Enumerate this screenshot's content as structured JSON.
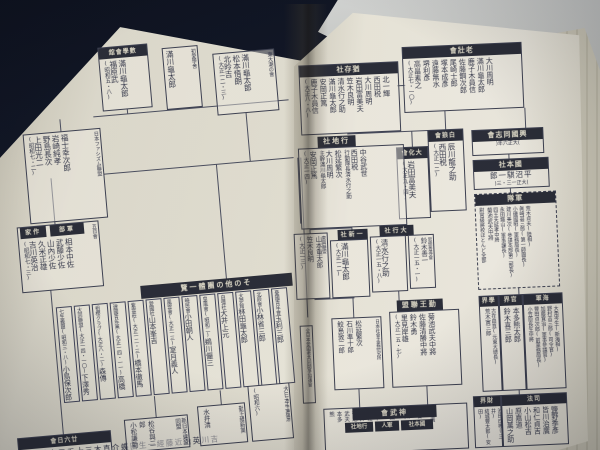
{
  "photo": {
    "background": "#11151f",
    "left_page": "#e4e0d0",
    "right_page": "#f0ecdd",
    "ink": "#343748",
    "header_bg": "#2b2d36",
    "header_fg": "#e4dfcb"
  },
  "left_page": {
    "box_a": {
      "header": "數學會舘",
      "members": [
        "滿川龜太郎",
        "福原武",
        "(昭和五・八)"
      ]
    },
    "box_b": {
      "side_label": "初愛學舍",
      "members": [
        "滿川龜太郎"
      ]
    },
    "box_c": {
      "side_label": "東大潮の會",
      "members": [
        "滿川龜太郎",
        "松本悟朗",
        "北昤吉",
        "(大正一二・三)"
      ]
    },
    "fascism_league": {
      "side_label": "日本ファシズム聯盟",
      "members": [
        "福士幸次郎",
        "岩崎純孝",
        "野島長次",
        "上田光二",
        "(昭和七・二)"
      ]
    },
    "itsukakai": {
      "side_label": "五日會",
      "header_sakka": "作家",
      "header_gunbu": "軍部",
      "members": [
        "相本中佐",
        "武藤少佐",
        "山內少佐",
        "久米正雄",
        "吉川英治",
        "(昭和七・三)"
      ]
    },
    "band": {
      "header": "その他の團體一覽",
      "entries": [
        {
          "label": "七生義團(昭和三・八)",
          "name": "小島保次郎"
        },
        {
          "label": "大同聯盟(大正一四・一〇)",
          "name": "下澤秀夫"
        },
        {
          "label": "祖櫻クラブ(大正八・二)",
          "name": "森傳"
        },
        {
          "label": "建國青年黨(大正一四・一一)",
          "name": "高橋佐三郎"
        },
        {
          "label": "紫雲莊(大正一二・三)",
          "name": "橋本徹馬"
        },
        {
          "label": "愛國社",
          "name": "山本峯吉"
        },
        {
          "label": "風雲會(大正一三)",
          "name": "室月義人"
        },
        {
          "label": "曉民會",
          "name": "小田朝人"
        },
        {
          "label": "皇風會(昭和二)",
          "name": "鵜川儼三"
        },
        {
          "label": "自彊社",
          "name": "大井上元"
        },
        {
          "label": "大夢館",
          "name": "林田龜太郎"
        },
        {
          "label": "北辰會",
          "name": "小林省三郎"
        },
        {
          "label": "憂國青年會",
          "name": "玉利三郎"
        }
      ]
    },
    "writers_box": {
      "header": "廿六日會",
      "members": [
        "吉川英治",
        "近藤經一",
        "生田蝶介",
        "直木三十五",
        "三上於菟吉"
      ]
    },
    "bottom_box_1": {
      "side_label": "新日本建設同盟",
      "members": [
        "松谷與二郎",
        "小松謙助"
      ]
    },
    "bottom_box_2": {
      "side_label": "勤王維新黨",
      "members": [
        "水井清"
      ]
    },
    "bottom_box_3": {
      "side_label": "大日本生產黨",
      "members": [
        "(昭和六)"
      ]
    }
  },
  "right_page": {
    "rosokai": {
      "header": "老壯會",
      "members": [
        "大川周明",
        "滿川龜太郎",
        "鹿子木員信",
        "佐藤鋼次郎",
        "尾崎士郎",
        "塚本成彥",
        "遠藤無水",
        "堺利彥",
        "高畠素之",
        "(大正七・一〇)"
      ]
    },
    "yuzonsha": {
      "header": "猶存社",
      "members": [
        "北一輝",
        "西田税",
        "大川周明",
        "岩田富美夫",
        "笠木良明",
        "清水行之助",
        "滿川龜太郎",
        "安岡正篤",
        "鹿子木員信",
        "(大正八・八)"
      ]
    },
    "hakurokai": {
      "header": "白狼會",
      "members": [
        "辰川龍之助",
        "西田税",
        "(大正一二)"
      ]
    },
    "taikakai": {
      "header": "大化會",
      "members": [
        "岩田富美夫",
        "(大正九・四)"
      ]
    },
    "kokoku_doshikai": {
      "header": "興國同志會",
      "date": "(大正六年)"
    },
    "kokuhonsha": {
      "header": "國本社",
      "member": "平沼騏一郎",
      "date": "(大正一三・三)"
    },
    "guntai": {
      "header": "軍隊",
      "members": [
        "荒木貞夫(陸相)",
        "眞崎甚三郎(第一師團長)",
        "小磯國昭(軍務局長)",
        "建川美次(參謀本部第二部長)",
        "永田鐵山(軍事課長)",
        "四王天延孝中將",
        "菊池武夫中將",
        "尉官級將校ほとんど全部"
      ]
    },
    "gyochisha": {
      "header": "行地社",
      "members": [
        "中谷武世",
        "西田税",
        "行動隊長清水行之助",
        "松延繁次",
        "大川周明",
        "主幹滿川龜太郎",
        "安岡正篤",
        "(大正一四)"
      ]
    },
    "isshinsha": {
      "header": "一新社",
      "members": [
        "滿川龜太郎",
        "(大正一二)"
      ]
    },
    "tokorenmei": {
      "side_label": "東興聯盟",
      "members": [
        "山本重太郎",
        "笠木良明",
        "(大正一三)"
      ]
    },
    "taikosha": {
      "header": "大行社",
      "members": [
        "清水行之助",
        "(大正一五・八)"
      ]
    },
    "shiso_zendokai": {
      "side_label": "思想善導會",
      "members": [
        "鈴木善一",
        "(大正一五・一)"
      ]
    },
    "kinno_renmei": {
      "header": "勤王聯盟",
      "members": [
        "菊池武夫中將",
        "佐藤清勝中將",
        "鈴木勇",
        "里見岸雄",
        "(大正一五・七)"
      ]
    },
    "shugi_lab": {
      "side_label": "日本社會主義研究所",
      "members": [
        "松延繁次",
        "石川準十郎",
        "鮫島敦二郎"
      ]
    },
    "zen_nihon": {
      "side_label": "全日本愛國者共同鬪爭協議會"
    },
    "sectors": {
      "gakkai": {
        "header": "學界",
        "members": [
          "古在由直(元東大總長)",
          "荒木寅三郎"
        ]
      },
      "kankai": {
        "header": "官界",
        "members": [
          "本多熊太郎",
          "鈴木喜三郎"
        ]
      },
      "kaigun": {
        "header": "海軍",
        "members": [
          "大角岑生(新海相)",
          "野村吉三郎(司令官)",
          "加藤寛治(軍事參議官)",
          "豐田貞次郎(前軍務局長)",
          "小笠原長生中將"
        ]
      },
      "zaikai": {
        "header": "財界",
        "members": [
          "池田成彬(三井)",
          "結城豐太郎(安田)"
        ]
      },
      "shiho": {
        "header": "司法",
        "members": [
          "鹽野季彥",
          "皆川治廣",
          "和仁貞吉",
          "小山松吉",
          "原嘉道",
          "山岡萬之助"
        ]
      }
    },
    "jinmukai": {
      "header": "神武會",
      "sub_headers": [
        "行地社",
        "軍人",
        "國本社"
      ],
      "members": [
        "石原廣一郎(日滿)",
        "松川清",
        "野田俊",
        "河本大佐",
        "松井",
        "菊池武夫",
        "本多熊"
      ]
    }
  }
}
